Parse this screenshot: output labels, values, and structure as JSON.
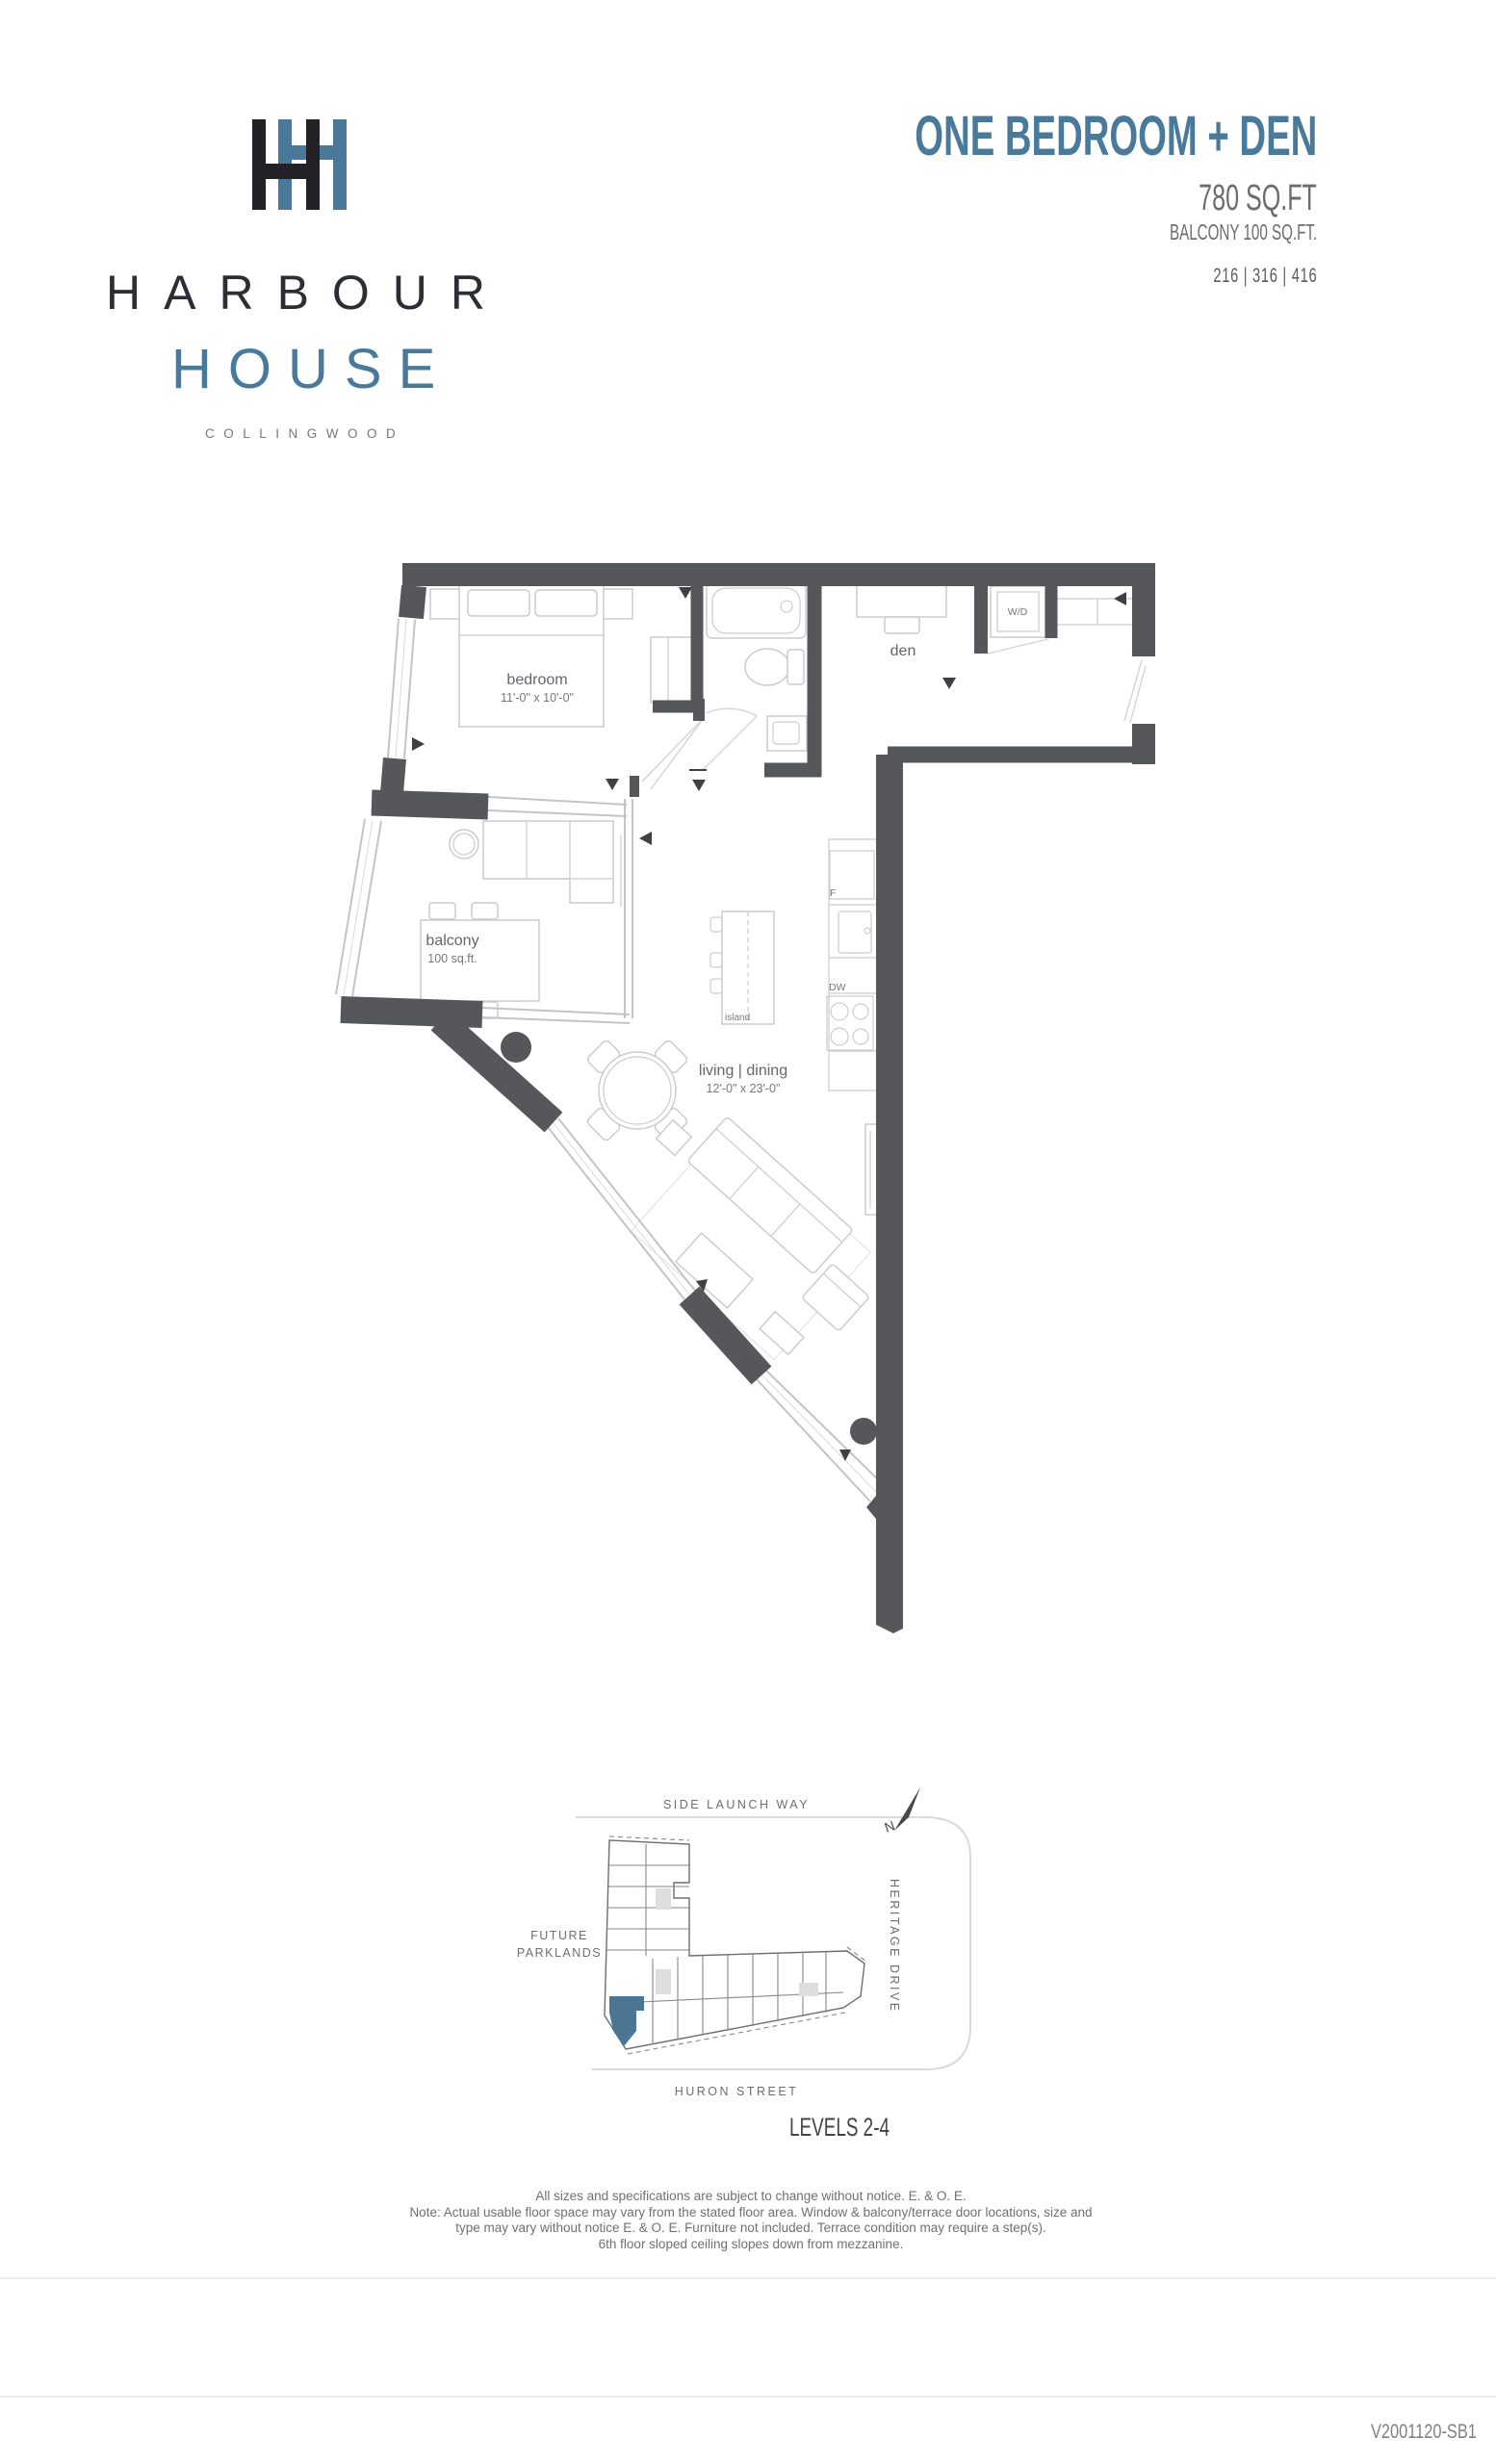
{
  "logo": {
    "word1": "HARBOUR",
    "word2": "HOUSE",
    "word3": "COLLINGWOOD"
  },
  "header": {
    "title": "ONE BEDROOM + DEN",
    "area": "780 SQ.FT",
    "balcony": "BALCONY 100 SQ.FT.",
    "units": "216 | 316 | 416"
  },
  "plan": {
    "bedroom_label": "bedroom",
    "bedroom_dims": "11'-0\" x 10'-0\"",
    "den_label": "den",
    "living_label": "living | dining",
    "living_dims": "12'-0\" x 23'-0\"",
    "balcony_label": "balcony",
    "balcony_area": "100 sq.ft.",
    "island_label": "island",
    "washer_dryer": "W/D",
    "fridge": "F",
    "dishwasher": "DW"
  },
  "site": {
    "street_top": "SIDE LAUNCH WAY",
    "street_right": "HERITAGE DRIVE",
    "street_bottom": "HURON STREET",
    "parklands_line1": "FUTURE",
    "parklands_line2": "PARKLANDS",
    "levels": "LEVELS 2-4",
    "north": "N"
  },
  "footer": {
    "disclaimer": [
      "All sizes and specifications are subject to change without notice. E. & O. E.",
      "Note: Actual usable floor space may vary from the stated floor area.  Window & balcony/terrace door locations, size and",
      "type may vary without notice E. & O. E.   Furniture not included.  Terrace condition may require a step(s).",
      "6th floor sloped ceiling slopes down from mezzanine."
    ],
    "version": "V2001120-SB1"
  },
  "colors": {
    "accent_blue": "#4a7a9b",
    "wall_gray": "#55575b",
    "unit_highlight": "#4a7593",
    "text_gray": "#6d6e71"
  }
}
